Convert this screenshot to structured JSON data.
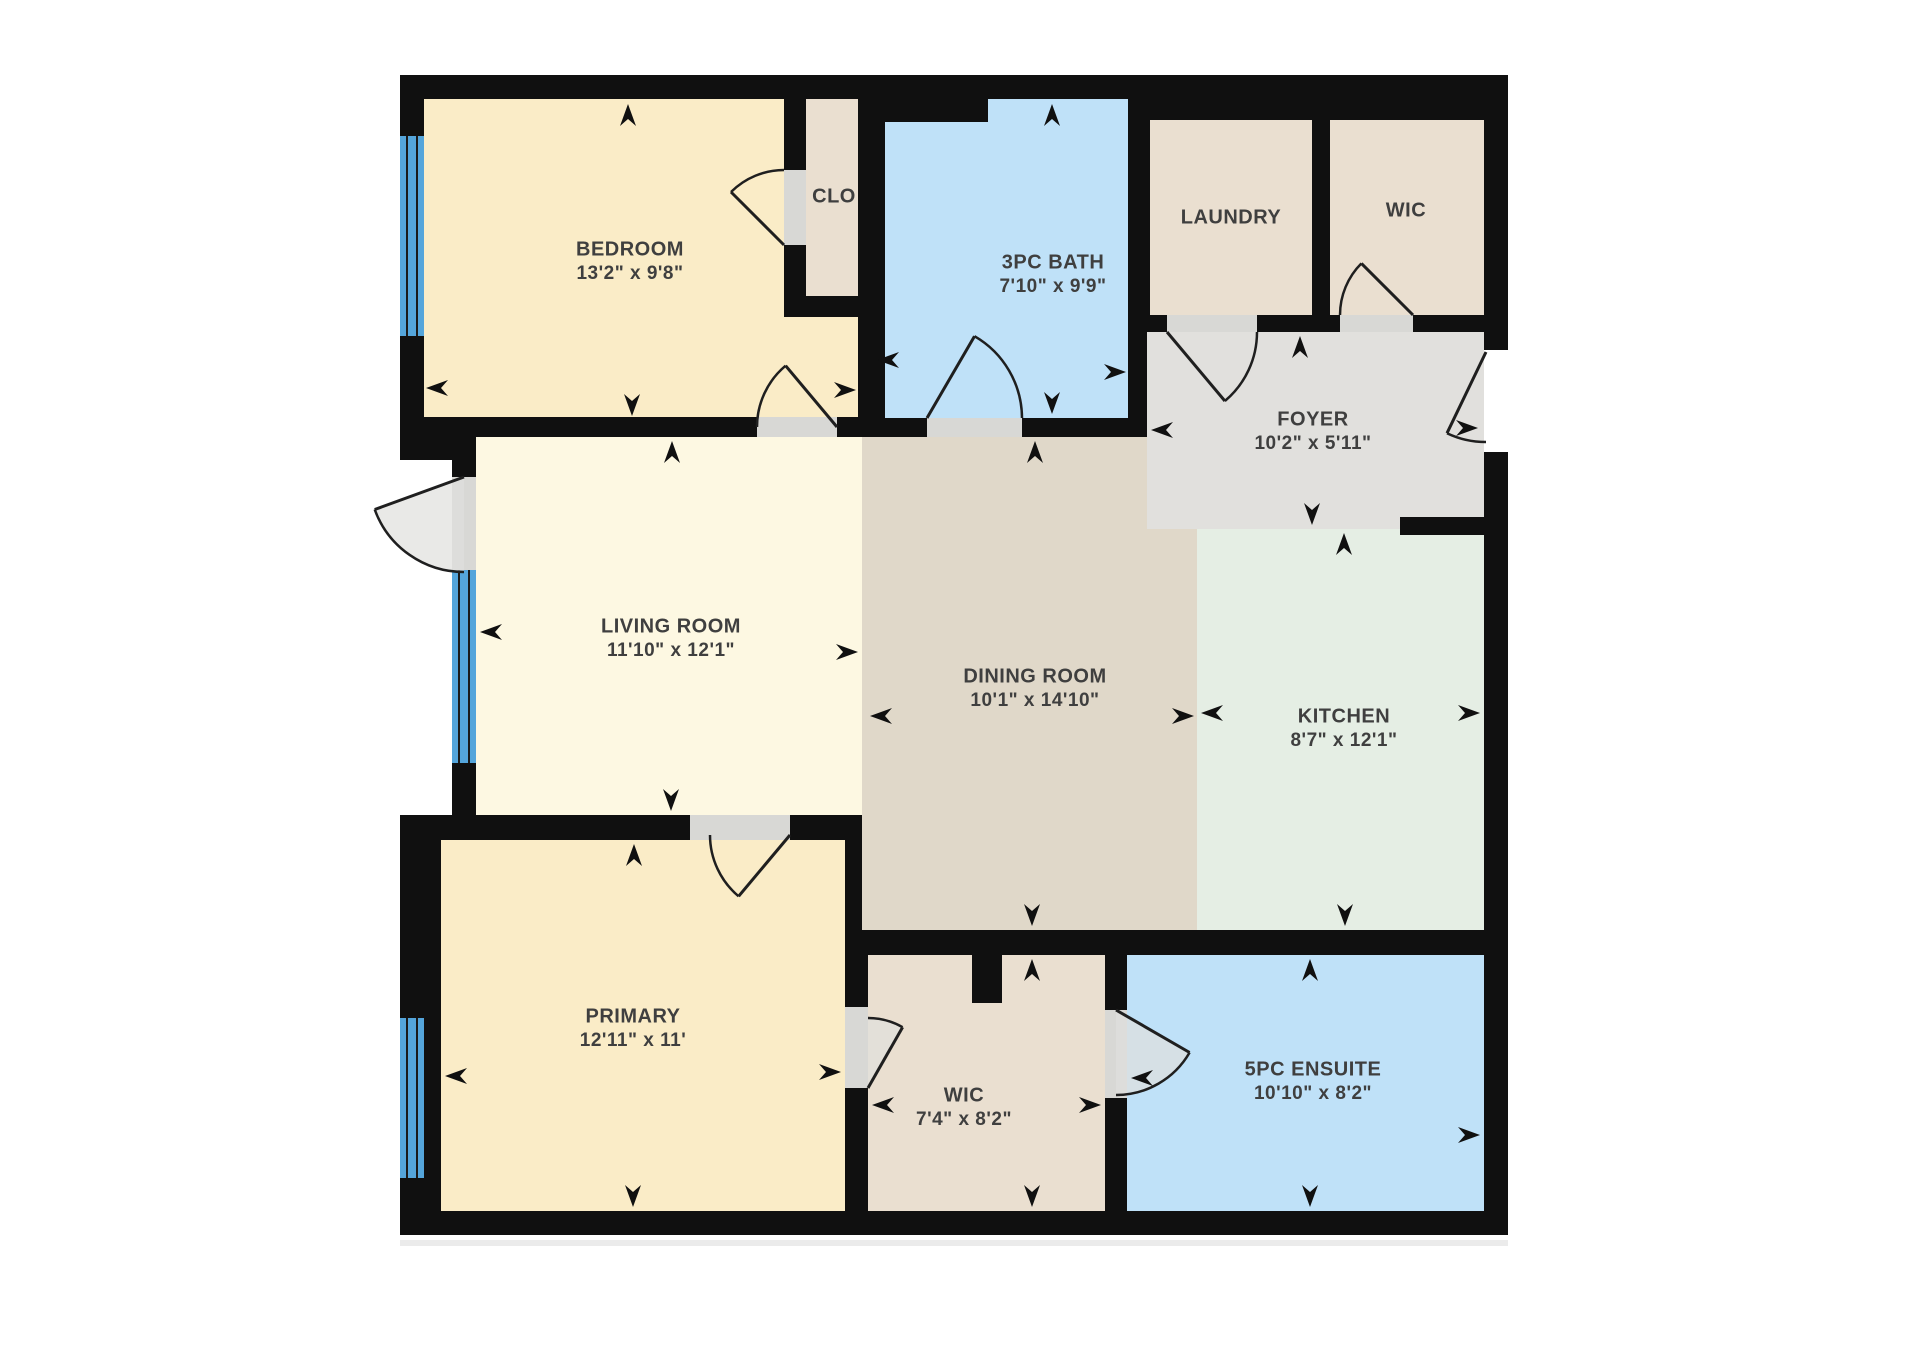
{
  "title": "Apartment Floor Plan",
  "colors": {
    "wall": "#101010",
    "background": "#ffffff",
    "bedroom": "#faecc7",
    "closet_tan": "#eadfd0",
    "bath_blue": "#bfe1f8",
    "foyer_gray": "#e1e0dd",
    "living_cream": "#fdf8e2",
    "dining_beige": "#e0d8c9",
    "kitchen_green": "#e5eee4",
    "opening_gray": "#d8d8d5",
    "window_blue": "#54a5db",
    "text": "#3f3f3f"
  },
  "rooms": [
    {
      "name": "BEDROOM",
      "dims": "13'2\" x 9'8\""
    },
    {
      "name": "CLO",
      "dims": ""
    },
    {
      "name": "3PC BATH",
      "dims": "7'10\" x 9'9\""
    },
    {
      "name": "LAUNDRY",
      "dims": ""
    },
    {
      "name": "WIC",
      "dims": ""
    },
    {
      "name": "FOYER",
      "dims": "10'2\" x 5'11\""
    },
    {
      "name": "LIVING ROOM",
      "dims": "11'10\" x 12'1\""
    },
    {
      "name": "DINING ROOM",
      "dims": "10'1\" x 14'10\""
    },
    {
      "name": "KITCHEN",
      "dims": "8'7\" x 12'1\""
    },
    {
      "name": "PRIMARY",
      "dims": "12'11\" x 11'"
    },
    {
      "name": "WIC",
      "dims": "7'4\" x 8'2\""
    },
    {
      "name": "5PC ENSUITE",
      "dims": "10'10\" x 8'2\""
    }
  ]
}
